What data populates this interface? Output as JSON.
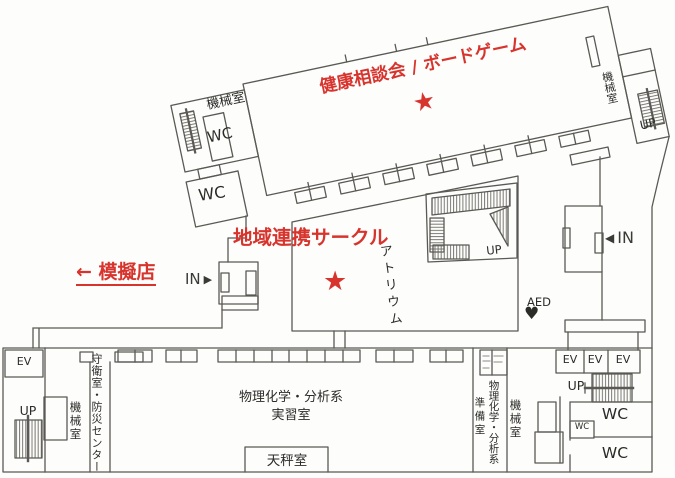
{
  "colors": {
    "accent_red": "#d8342e",
    "wall_gray": "#5a5955",
    "label_black": "#2b2b28"
  },
  "annotations": {
    "health_event": "健康相談会 / ボードゲーム",
    "circle_event": "地域連携サークル",
    "food_stalls": "← 模擬店",
    "star": "★"
  },
  "markers": {
    "in_label": "IN",
    "arrow_right": "▶",
    "arrow_left": "◀",
    "aed_label": "AED",
    "aed_heart": "♥"
  },
  "rooms": {
    "machine_room": "機械室",
    "wc": "WC",
    "ev": "EV",
    "up": "UP",
    "atrium": "アトリウム",
    "guard_disaster_center": "守衛室・防災センター",
    "lab_line1": "物理化学・分析系",
    "lab_line2": "実習室",
    "balance_room": "天秤室",
    "prep_line1": "物理化学・分析系",
    "prep_line2": "準備室"
  }
}
